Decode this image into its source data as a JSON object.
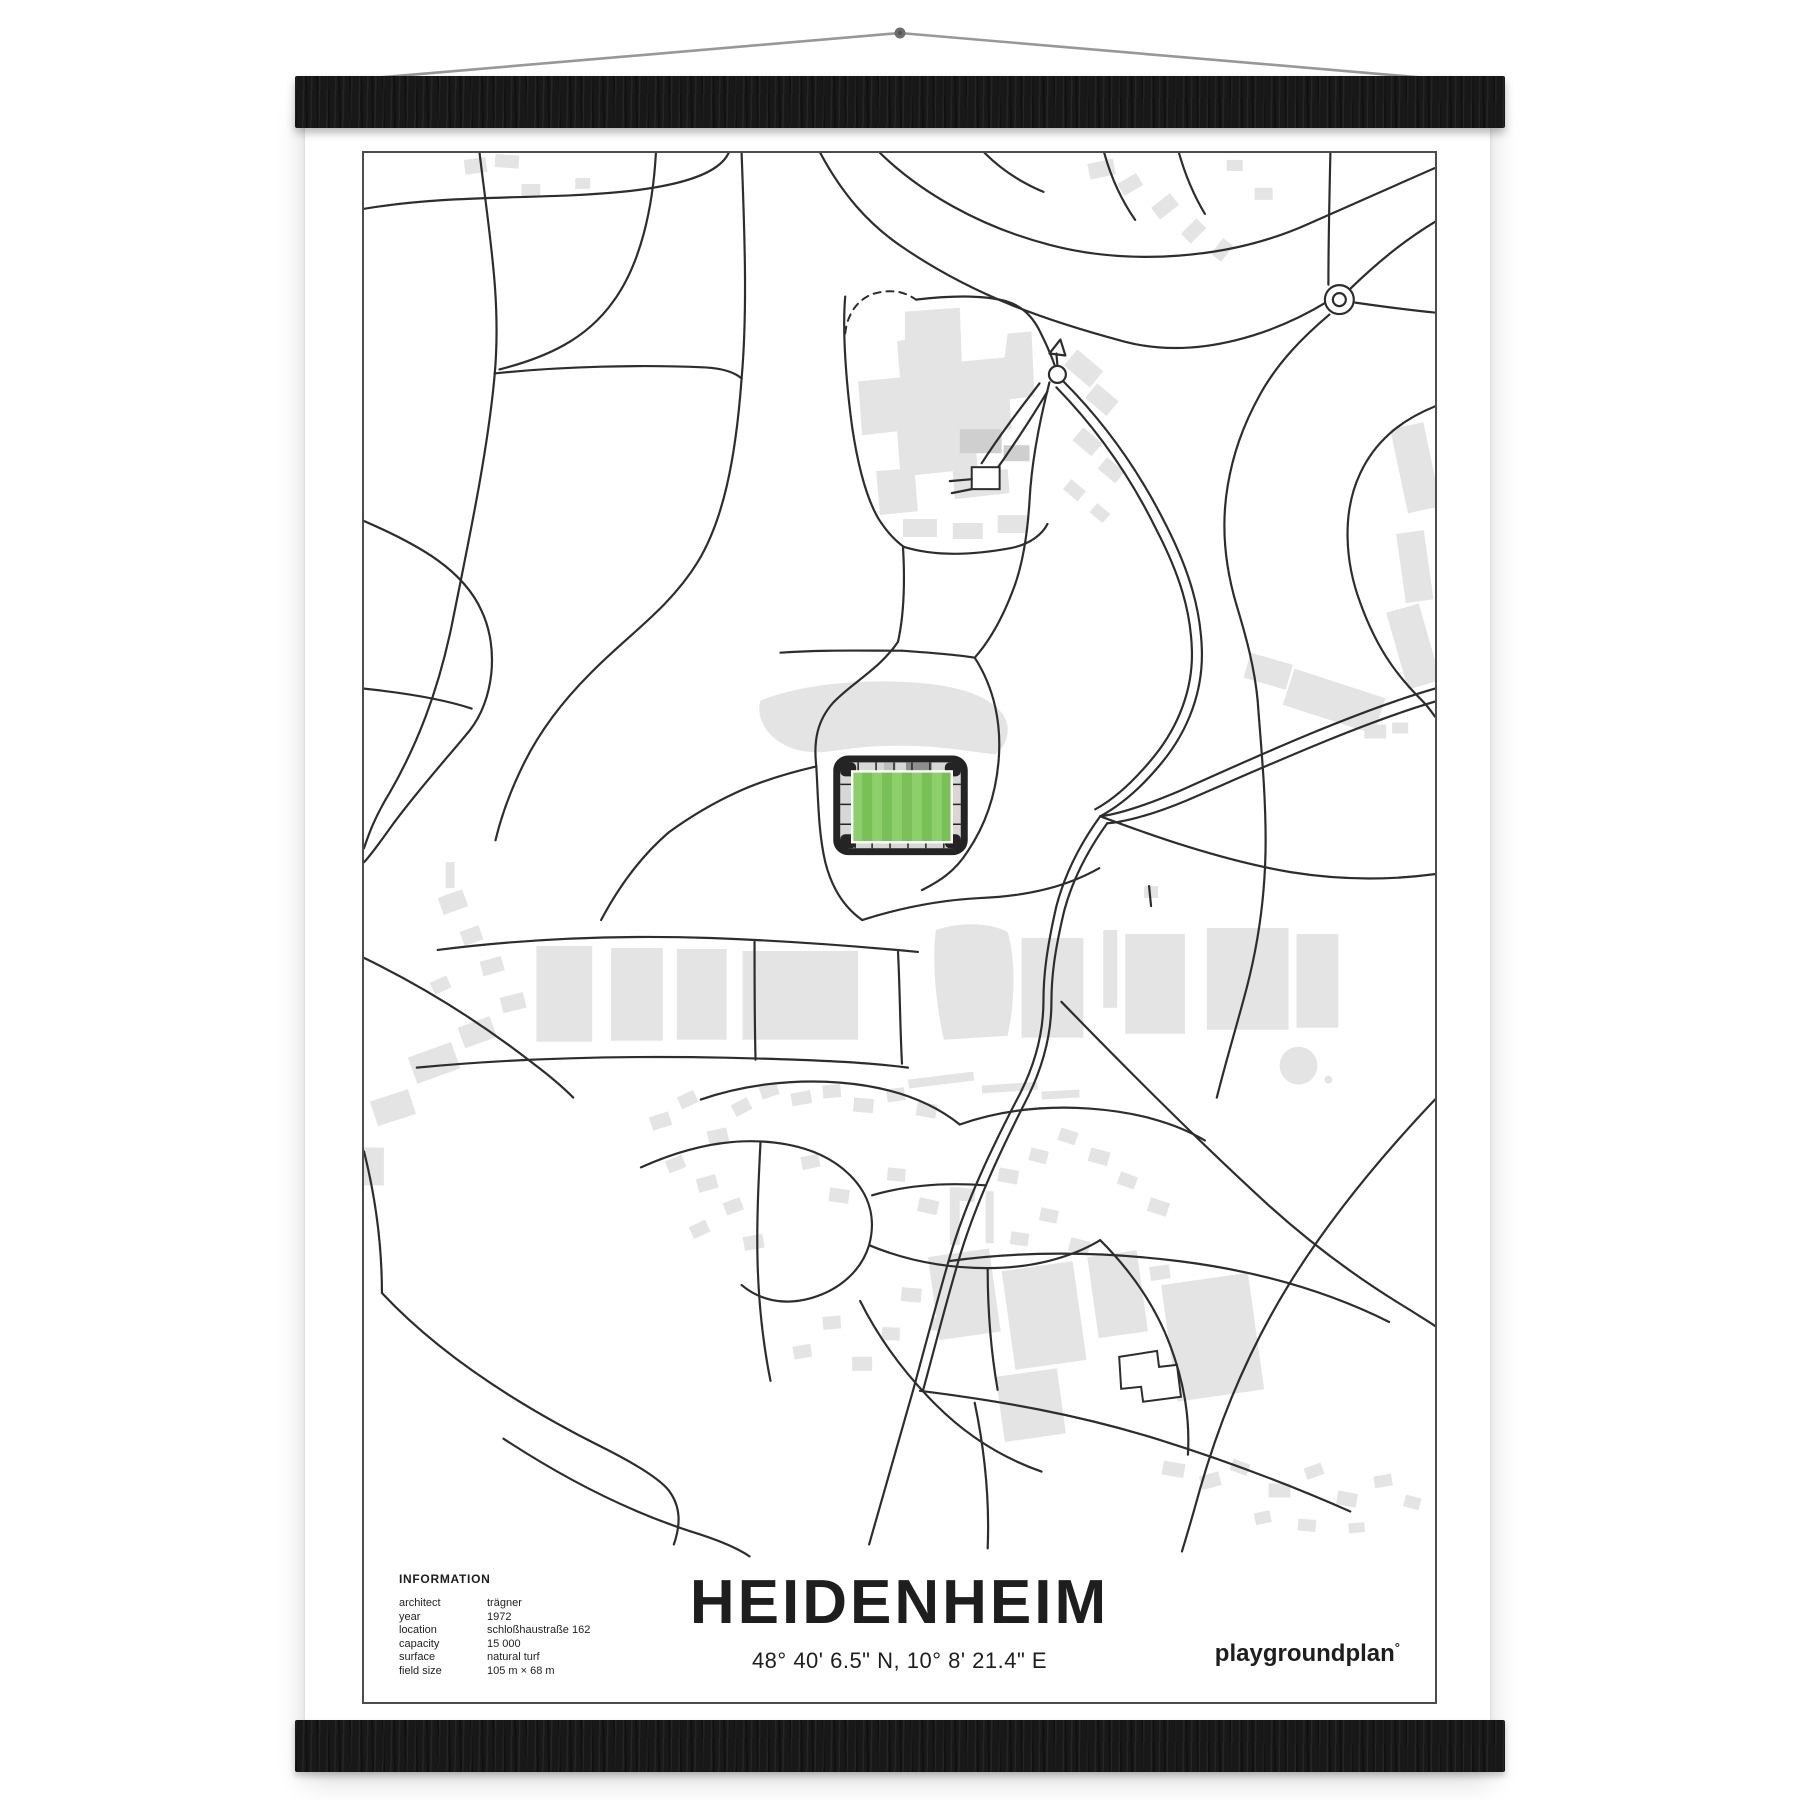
{
  "poster": {
    "title": "HEIDENHEIM",
    "coordinates": "48° 40' 6.5\" N, 10° 8' 21.4\" E",
    "brand_name": "playgroundplan",
    "brand_mark": "°",
    "info": {
      "heading": "INFORMATION",
      "rows": [
        {
          "key": "architect",
          "value": "trägner"
        },
        {
          "key": "year",
          "value": "1972"
        },
        {
          "key": "location",
          "value": "schloßhaustraße 162"
        },
        {
          "key": "capacity",
          "value": "15 000"
        },
        {
          "key": "surface",
          "value": "natural turf"
        },
        {
          "key": "field size",
          "value": "105 m × 68 m"
        }
      ]
    }
  },
  "colors": {
    "page_bg": "#ffffff",
    "poster_bg": "#ffffff",
    "rail": "#181818",
    "string_color": "#989898",
    "nail": "#6e6e6e",
    "frame": "#4c4c4c",
    "road": "#2d2d2d",
    "building": "#e4e4e4",
    "building_dark": "#cfcfcf",
    "stand": "#d7d7d7",
    "stadium_shell": "#242424",
    "pitch_light": "#8ccf6b",
    "pitch_dark": "#79c156",
    "pitch_line": "#ffffff",
    "text": "#1e1e1e"
  }
}
